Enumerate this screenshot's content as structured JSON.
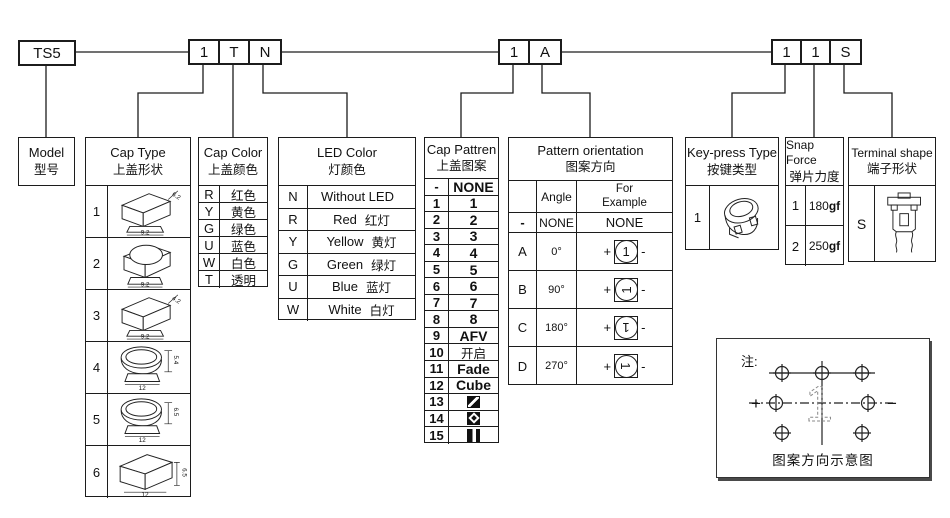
{
  "top_codes": {
    "model": "TS5",
    "group1": [
      "1",
      "T",
      "N"
    ],
    "group2": [
      "1",
      "A"
    ],
    "group3": [
      "1",
      "1",
      "S"
    ]
  },
  "model_box": {
    "en": "Model",
    "zh": "型号"
  },
  "cap_type": {
    "en": "Cap Type",
    "zh": "上盖形状",
    "rows": [
      {
        "code": "1",
        "shape": "square-cap",
        "top_dim": "6.2",
        "base_dim": "9.2"
      },
      {
        "code": "2",
        "shape": "round-top-cap",
        "base_dim": "9.2"
      },
      {
        "code": "3",
        "shape": "square-cap",
        "top_dim": "4.2",
        "base_dim": "9.2"
      },
      {
        "code": "4",
        "shape": "dome-cap",
        "side_dim": "5.4",
        "base_dim": "12"
      },
      {
        "code": "5",
        "shape": "dome-cap",
        "side_dim": "6.5",
        "base_dim": "12"
      },
      {
        "code": "6",
        "shape": "box-cap",
        "side_dim": "6.5",
        "base_dim": "12"
      }
    ]
  },
  "cap_color": {
    "en": "Cap Color",
    "zh": "上盖颜色",
    "rows": [
      {
        "code": "R",
        "label": "红色"
      },
      {
        "code": "Y",
        "label": "黄色"
      },
      {
        "code": "G",
        "label": "绿色"
      },
      {
        "code": "U",
        "label": "蓝色"
      },
      {
        "code": "W",
        "label": "白色"
      },
      {
        "code": "T",
        "label": "透明"
      }
    ]
  },
  "led_color": {
    "en": "LED Color",
    "zh": "灯颜色",
    "rows": [
      {
        "code": "N",
        "en": "Without LED",
        "zh": ""
      },
      {
        "code": "R",
        "en": "Red",
        "zh": "红灯"
      },
      {
        "code": "Y",
        "en": "Yellow",
        "zh": "黄灯"
      },
      {
        "code": "G",
        "en": "Green",
        "zh": "绿灯"
      },
      {
        "code": "U",
        "en": "Blue",
        "zh": "蓝灯"
      },
      {
        "code": "W",
        "en": "White",
        "zh": "白灯"
      }
    ]
  },
  "cap_pattern": {
    "en": "Cap Pattren",
    "zh": "上盖图案",
    "rows": [
      {
        "code": "-",
        "label": "NONE"
      },
      {
        "code": "1",
        "label": "1"
      },
      {
        "code": "2",
        "label": "2"
      },
      {
        "code": "3",
        "label": "3"
      },
      {
        "code": "4",
        "label": "4"
      },
      {
        "code": "5",
        "label": "5"
      },
      {
        "code": "6",
        "label": "6"
      },
      {
        "code": "7",
        "label": "7"
      },
      {
        "code": "8",
        "label": "8"
      },
      {
        "code": "9",
        "label": "AFV"
      },
      {
        "code": "10",
        "label": "开启"
      },
      {
        "code": "11",
        "label": "Fade"
      },
      {
        "code": "12",
        "label": "Cube"
      },
      {
        "code": "13",
        "label": "",
        "icon": "diagonal-split-square"
      },
      {
        "code": "14",
        "label": "",
        "icon": "diamond-in-square"
      },
      {
        "code": "15",
        "label": "",
        "icon": "vertical-bar-square"
      }
    ]
  },
  "pattern_orientation": {
    "en": "Pattern orientation",
    "zh": "图案方向",
    "angle_header": "Angle",
    "example_header": "For Example",
    "plus": "+",
    "minus": "-",
    "rows": [
      {
        "code": "-",
        "angle": "NONE",
        "example": "NONE"
      },
      {
        "code": "A",
        "angle": "0°",
        "glyph": "1",
        "rotation": 0
      },
      {
        "code": "B",
        "angle": "90°",
        "glyph": "1",
        "rotation": -90
      },
      {
        "code": "C",
        "angle": "180°",
        "glyph": "1",
        "rotation": 180
      },
      {
        "code": "D",
        "angle": "270°",
        "glyph": "1",
        "rotation": 90
      }
    ]
  },
  "key_press": {
    "en": "Key-press Type",
    "zh": "按键类型",
    "rows": [
      {
        "code": "1",
        "drawing": "tact-switch-isometric"
      }
    ]
  },
  "snap_force": {
    "en": "Snap Force",
    "zh": "弹片力度",
    "rows": [
      {
        "code": "1",
        "value": "180",
        "unit": "gf"
      },
      {
        "code": "2",
        "value": "250",
        "unit": "gf"
      }
    ]
  },
  "terminal_shape": {
    "en": "Terminal shape",
    "zh": "端子形状",
    "rows": [
      {
        "code": "S",
        "drawing": "through-hole-switch-front"
      }
    ]
  },
  "note_box": {
    "label": "注:",
    "plus": "+",
    "minus": "−",
    "ghost_glyph": "1",
    "caption": "图案方向示意图"
  },
  "colors": {
    "line": "#1c1c1c",
    "background": "#ffffff",
    "text": "#111111"
  }
}
